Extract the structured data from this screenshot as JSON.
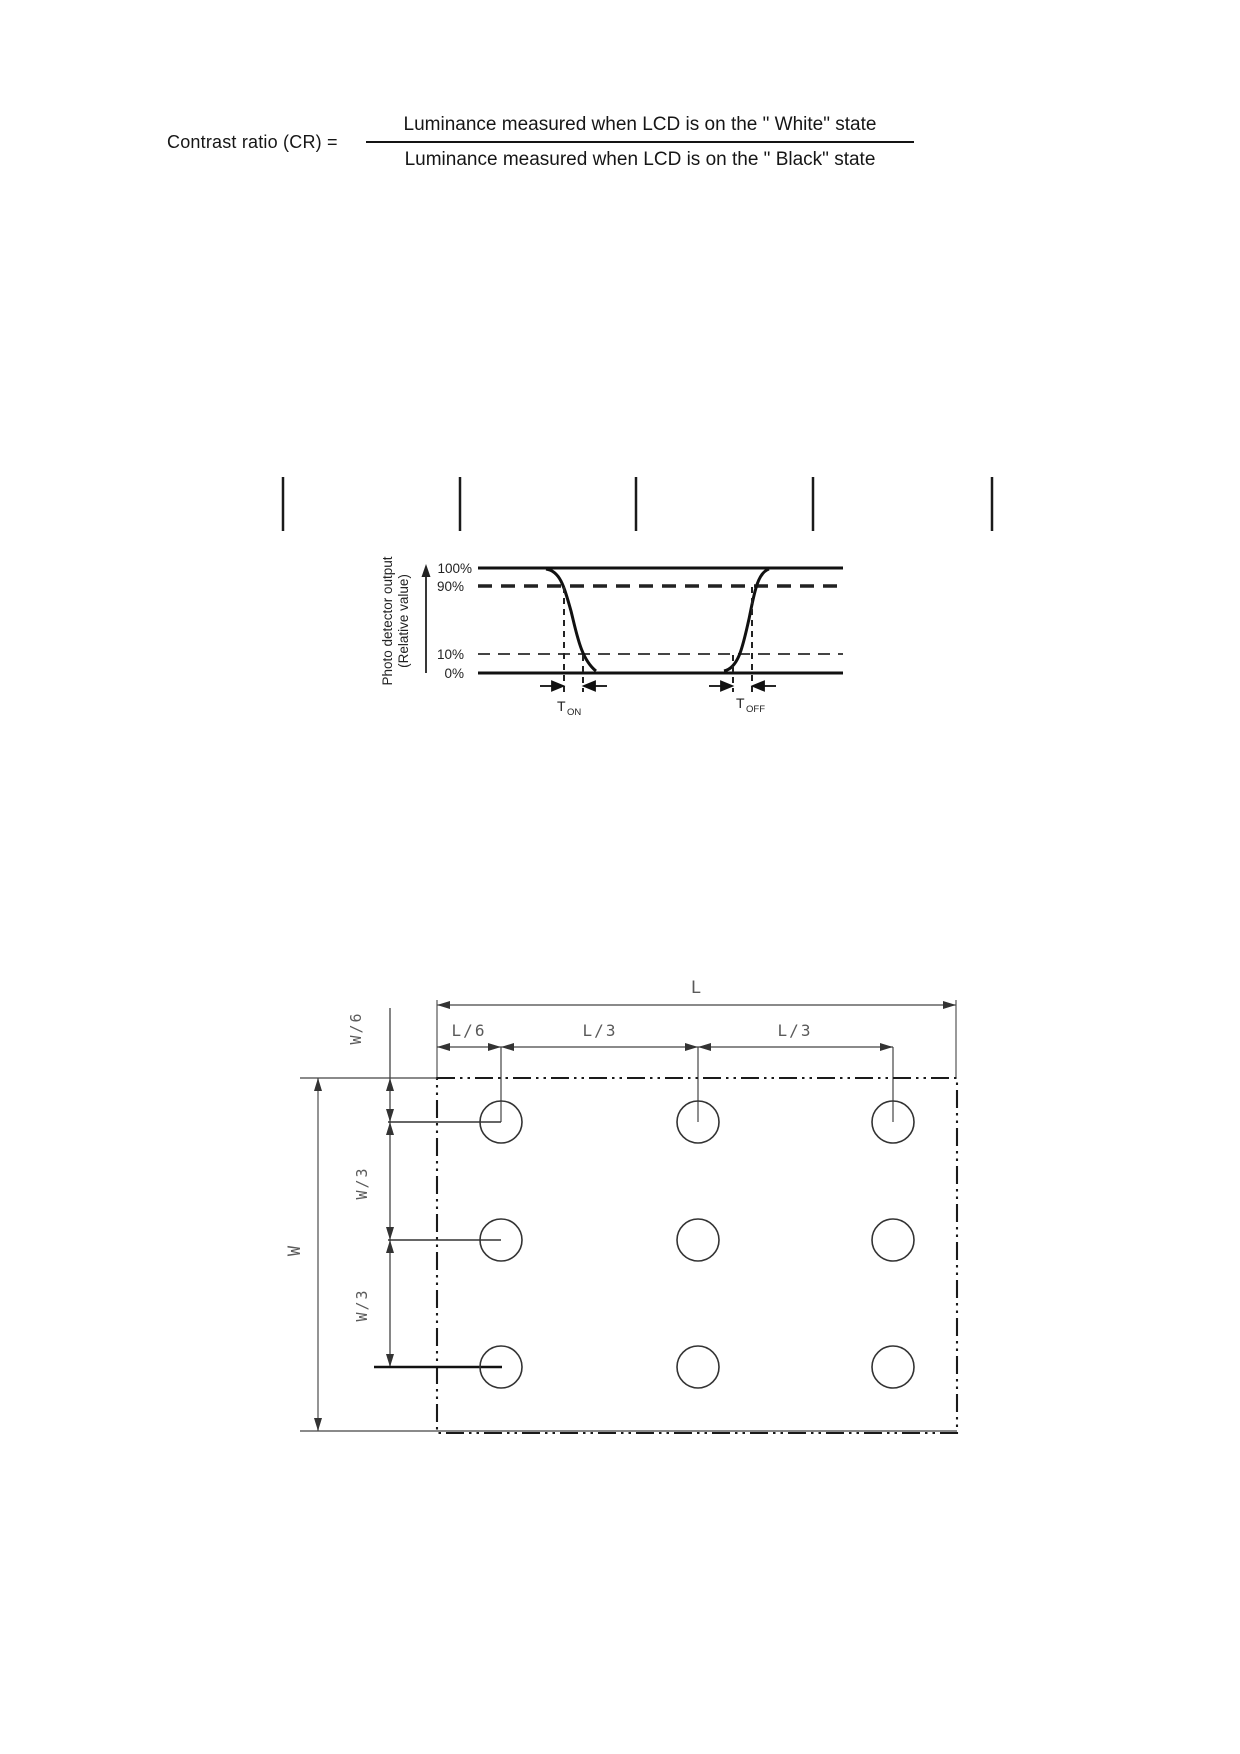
{
  "formula": {
    "lhs": "Contrast ratio (CR) =",
    "numerator": "Luminance measured when LCD is on the \" White\" state",
    "denominator": "Luminance measured when LCD is on the \" Black\" state"
  },
  "separator_ticks": {
    "count": 5
  },
  "response_graph": {
    "y_axis_label_line1": "Photo detector output",
    "y_axis_label_line2": "(Relative value)",
    "level_100": "100%",
    "level_90": "90%",
    "level_10": "10%",
    "level_0": "0%",
    "t_on_base": "T",
    "t_on_sub": "ON",
    "t_off_base": "T",
    "t_off_sub": "OFF"
  },
  "measurement_diagram": {
    "label_L": "L",
    "label_L6": "L/6",
    "label_L3_left": "L/3",
    "label_L3_right": "L/3",
    "label_W": "W",
    "label_W6": "W/6",
    "label_W3_upper": "W/3",
    "label_W3_lower": "W/3",
    "measurement_points": {
      "rows": 3,
      "cols": 3,
      "count": 9
    }
  },
  "chart_data": {
    "type": "line",
    "title": "",
    "ylabel": "Photo detector output (Relative value)",
    "y_reference_levels_percent": [
      100,
      90,
      10,
      0
    ],
    "waveform_percent_vs_relative_time": [
      [
        0,
        100
      ],
      [
        0.19,
        100
      ],
      [
        0.23,
        90
      ],
      [
        0.29,
        10
      ],
      [
        0.32,
        0
      ],
      [
        0.68,
        0
      ],
      [
        0.7,
        10
      ],
      [
        0.75,
        90
      ],
      [
        0.79,
        100
      ],
      [
        1,
        100
      ]
    ],
    "annotations": [
      "T_ON between 90% and 10% crossings of falling edge",
      "T_OFF between 10% and 90% crossings of rising edge"
    ],
    "legend_position": "none",
    "grid": false
  },
  "colors": {
    "ink": "#111111",
    "line_gray": "#444444",
    "cad_label_gray": "#5a5a5a",
    "paper": "#ffffff"
  }
}
